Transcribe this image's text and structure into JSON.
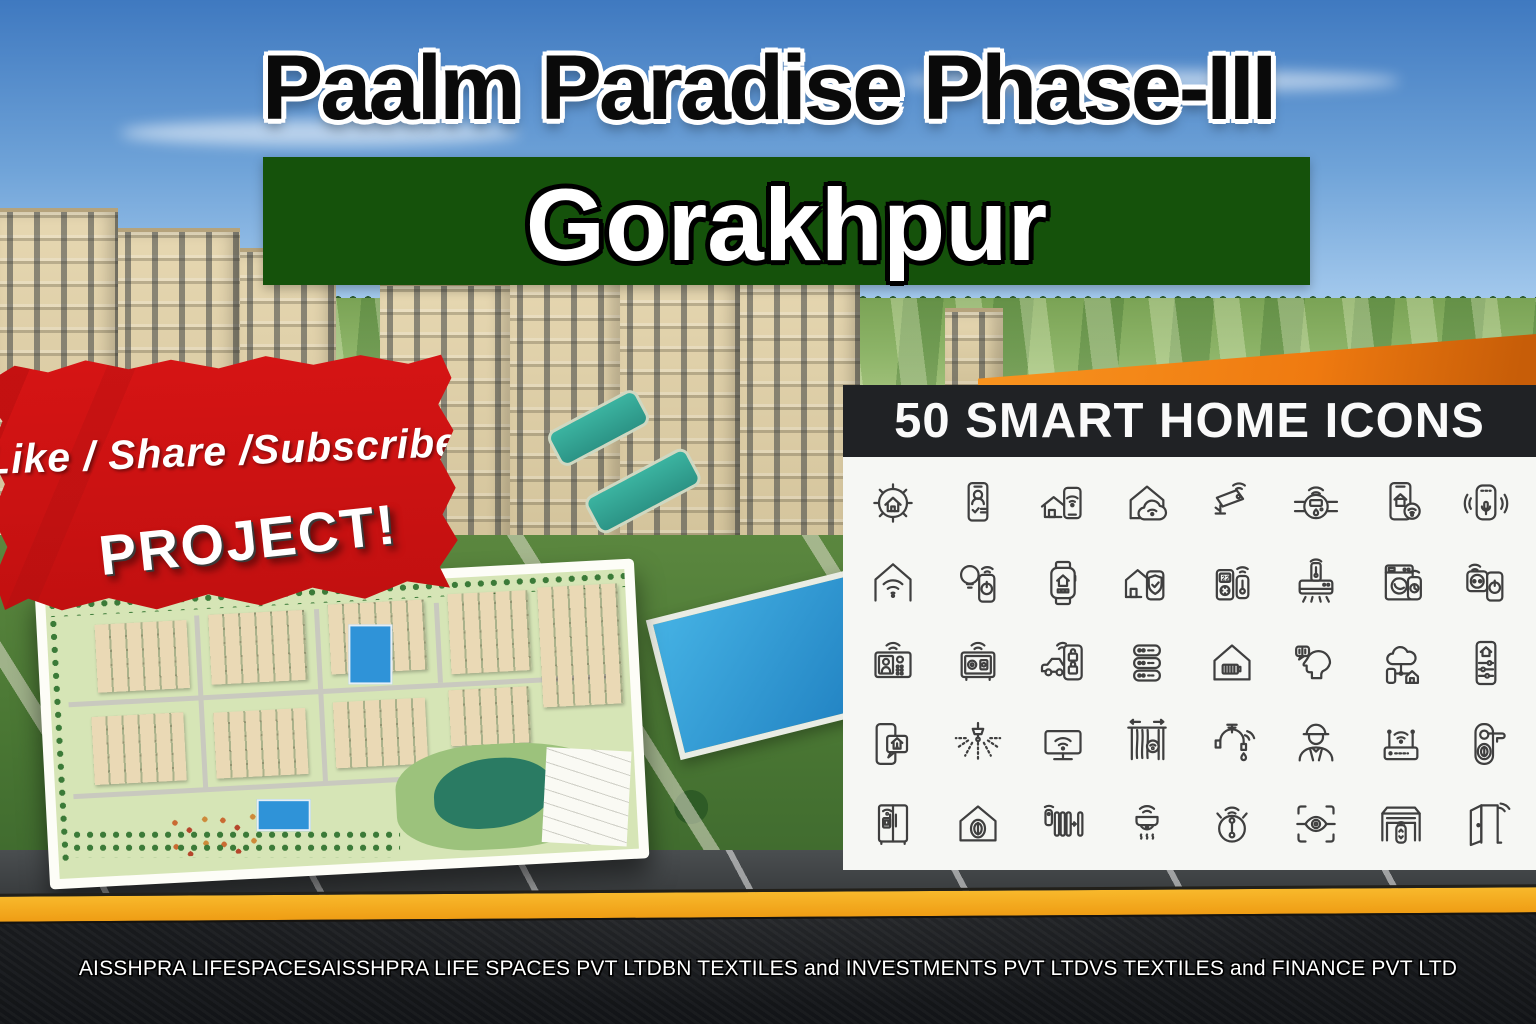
{
  "title": "Paalm Paradise Phase-III",
  "location_banner": {
    "text": "Gorakhpur",
    "bg_color": "#15520b"
  },
  "cta_banner": {
    "line1": "Like / Share /Subscribe",
    "line2": "PROJECT!",
    "bg_color": "#d61414"
  },
  "icons_panel": {
    "title": "50 SMART HOME ICONS",
    "bg_color": "#f6f7f4",
    "titlebar_color": "#202225",
    "thermostat_display": "22",
    "icons": [
      "smart-home-gear",
      "phone-profile-check",
      "home-phone-wifi",
      "home-cloud-wifi",
      "cctv-camera",
      "smart-meter",
      "phone-home-wifi",
      "smart-speaker",
      "home-wifi",
      "bulb-phone",
      "smartwatch-home",
      "home-shield-phone",
      "thermostat-remote",
      "air-conditioner",
      "washing-machine-phone",
      "socket-phone",
      "video-intercom",
      "smart-safe",
      "car-phone-lock",
      "server-rack",
      "home-battery",
      "voice-assistant",
      "cloud-network",
      "phone-home-sliders",
      "phone-home-alert",
      "sprinkler",
      "smart-tv",
      "smart-curtains",
      "smart-faucet",
      "technician",
      "wifi-router",
      "door-lock-fingerprint",
      "smart-fridge",
      "home-fingerprint",
      "radiator-remote",
      "smoke-detector",
      "robot-vacuum",
      "eye-scan",
      "garage-remote",
      "smart-door"
    ]
  },
  "footer": {
    "text": "AISSHPRA LIFESPACESAISSHPRA LIFE SPACES PVT LTDBN TEXTILES and INVESTMENTS PVT LTDVS TEXTILES and FINANCE PVT LTD",
    "stripe_color": "#f2a41d"
  },
  "colors": {
    "sky_top": "#3f79c0",
    "orange_swoosh": "#ef7a10",
    "red_banner": "#d61414",
    "green_banner": "#15520b",
    "panel_black": "#202225",
    "footer_black": "#141619"
  }
}
